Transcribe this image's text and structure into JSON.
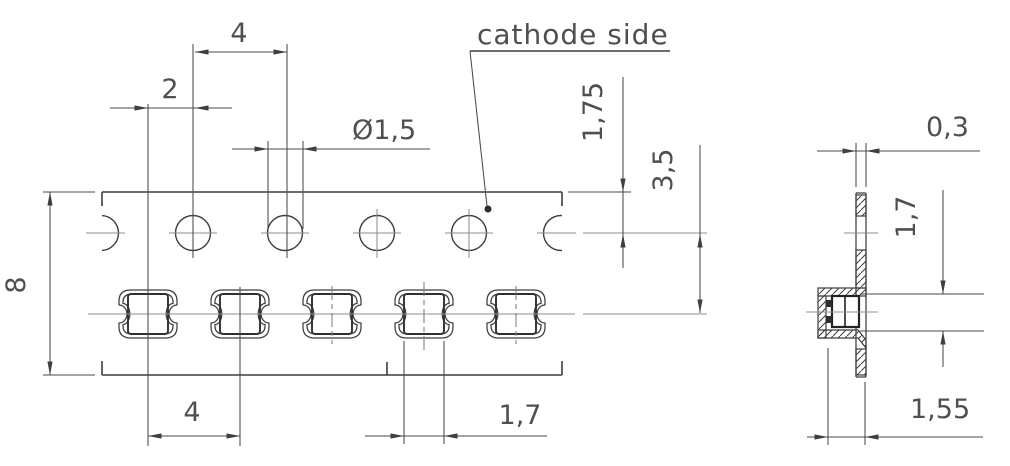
{
  "note": {
    "cathode": "cathode side"
  },
  "top_view": {
    "dim_hole_pitch": "4",
    "dim_hole_to_pocket_offset": "2",
    "dim_hole_diameter": "Ø1,5",
    "dim_edge_to_hole_center": "1,75",
    "dim_hole_to_pocket_center": "3,5",
    "dim_tape_width": "8",
    "dim_pocket_pitch": "4",
    "dim_pocket_opening": "1,7"
  },
  "side_view": {
    "dim_tape_thickness": "0,3",
    "dim_pocket_inner_height": "1,7",
    "dim_pocket_depth": "1,55"
  },
  "colors": {
    "background": "#ffffff",
    "contour_line": "#3d3d3d",
    "dimension_line": "#4a4a4a",
    "centerline": "#8f8f8f",
    "text": "#4f4f4f"
  }
}
